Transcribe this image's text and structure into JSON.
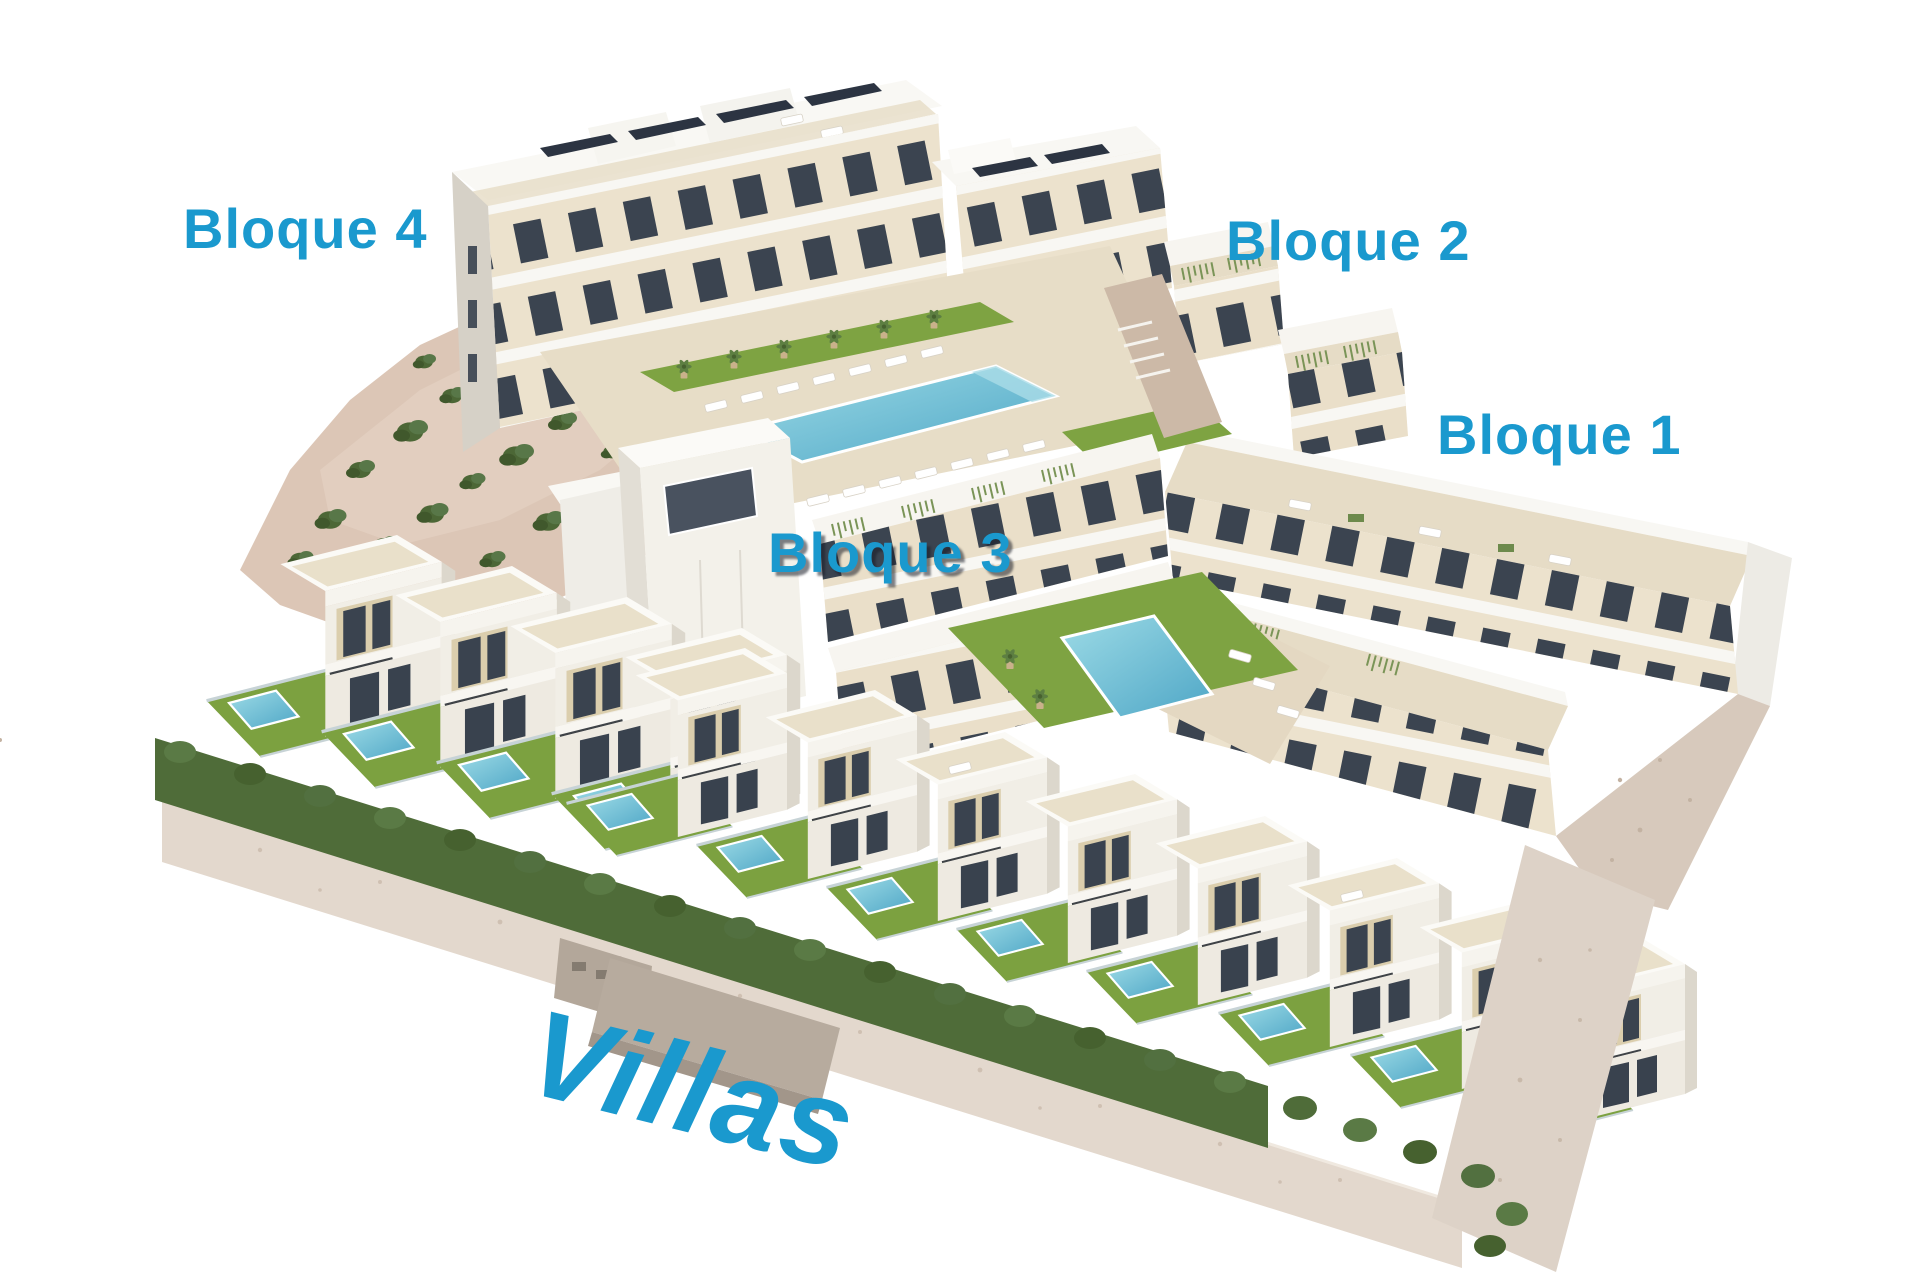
{
  "labels": {
    "bloque_4": "Bloque 4",
    "bloque_2": "Bloque 2",
    "bloque_1": "Bloque 1",
    "bloque_3": "Bloque 3",
    "villas": "Villas"
  },
  "colors": {
    "label_blue": "#1a99ce",
    "background": "#ffffff",
    "facade_cream": "#ece2cd",
    "facade_white": "#f6f4ef",
    "window_glass": "#3b4450",
    "solar_panel": "#2c3442",
    "lawn": "#7ca140",
    "hedge": "#4f6c39",
    "pool_water": "#57b0cc",
    "rock_ground": "#dcc6b6",
    "stone_wall": "#e3d8cd"
  }
}
